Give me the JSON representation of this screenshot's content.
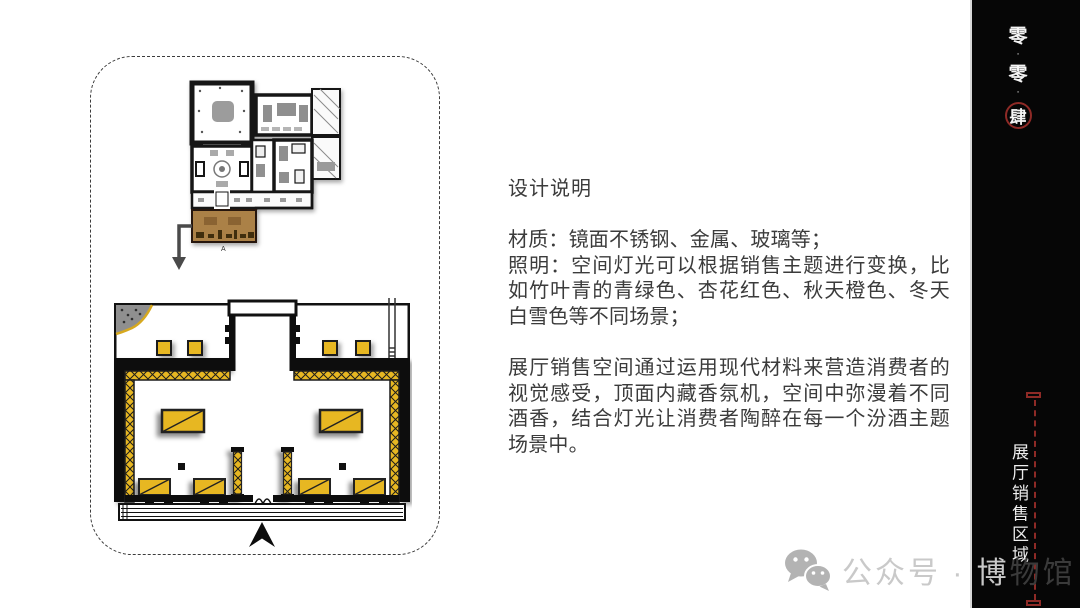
{
  "panel": {
    "design_title": "设计说明",
    "para_materials": "材质：镜面不锈钢、金属、玻璃等；\n照明：空间灯光可以根据销售主题进行变换，比如竹叶青的青绿色、杏花红色、秋天橙色、冬天白雪色等不同场景；",
    "para_space": "展厅销售空间通过运用现代材料来营造消费者的视觉感受，顶面内藏香氛机，空间中弥漫着不同酒香，结合灯光让消费者陶醉在每一个汾酒主题场景中。"
  },
  "plans": {
    "zone_label": "A"
  },
  "sidebar": {
    "page": {
      "c0": "零",
      "c1": "·",
      "c2": "零",
      "c3": "·",
      "c4": "肆"
    },
    "section_title": "展厅销售区域",
    "bg_color": "#060606",
    "accent_red": "#8e2a26"
  },
  "watermark": {
    "icon": "wechat-icon",
    "text_light": "公众号 · 博",
    "text_dark": "物馆"
  },
  "colors": {
    "accent_yellow": "#e7b722",
    "highlight_brown": "#ab8146",
    "text_dark": "#3b3b3b",
    "watermark_gray": "#c9c9c9"
  }
}
